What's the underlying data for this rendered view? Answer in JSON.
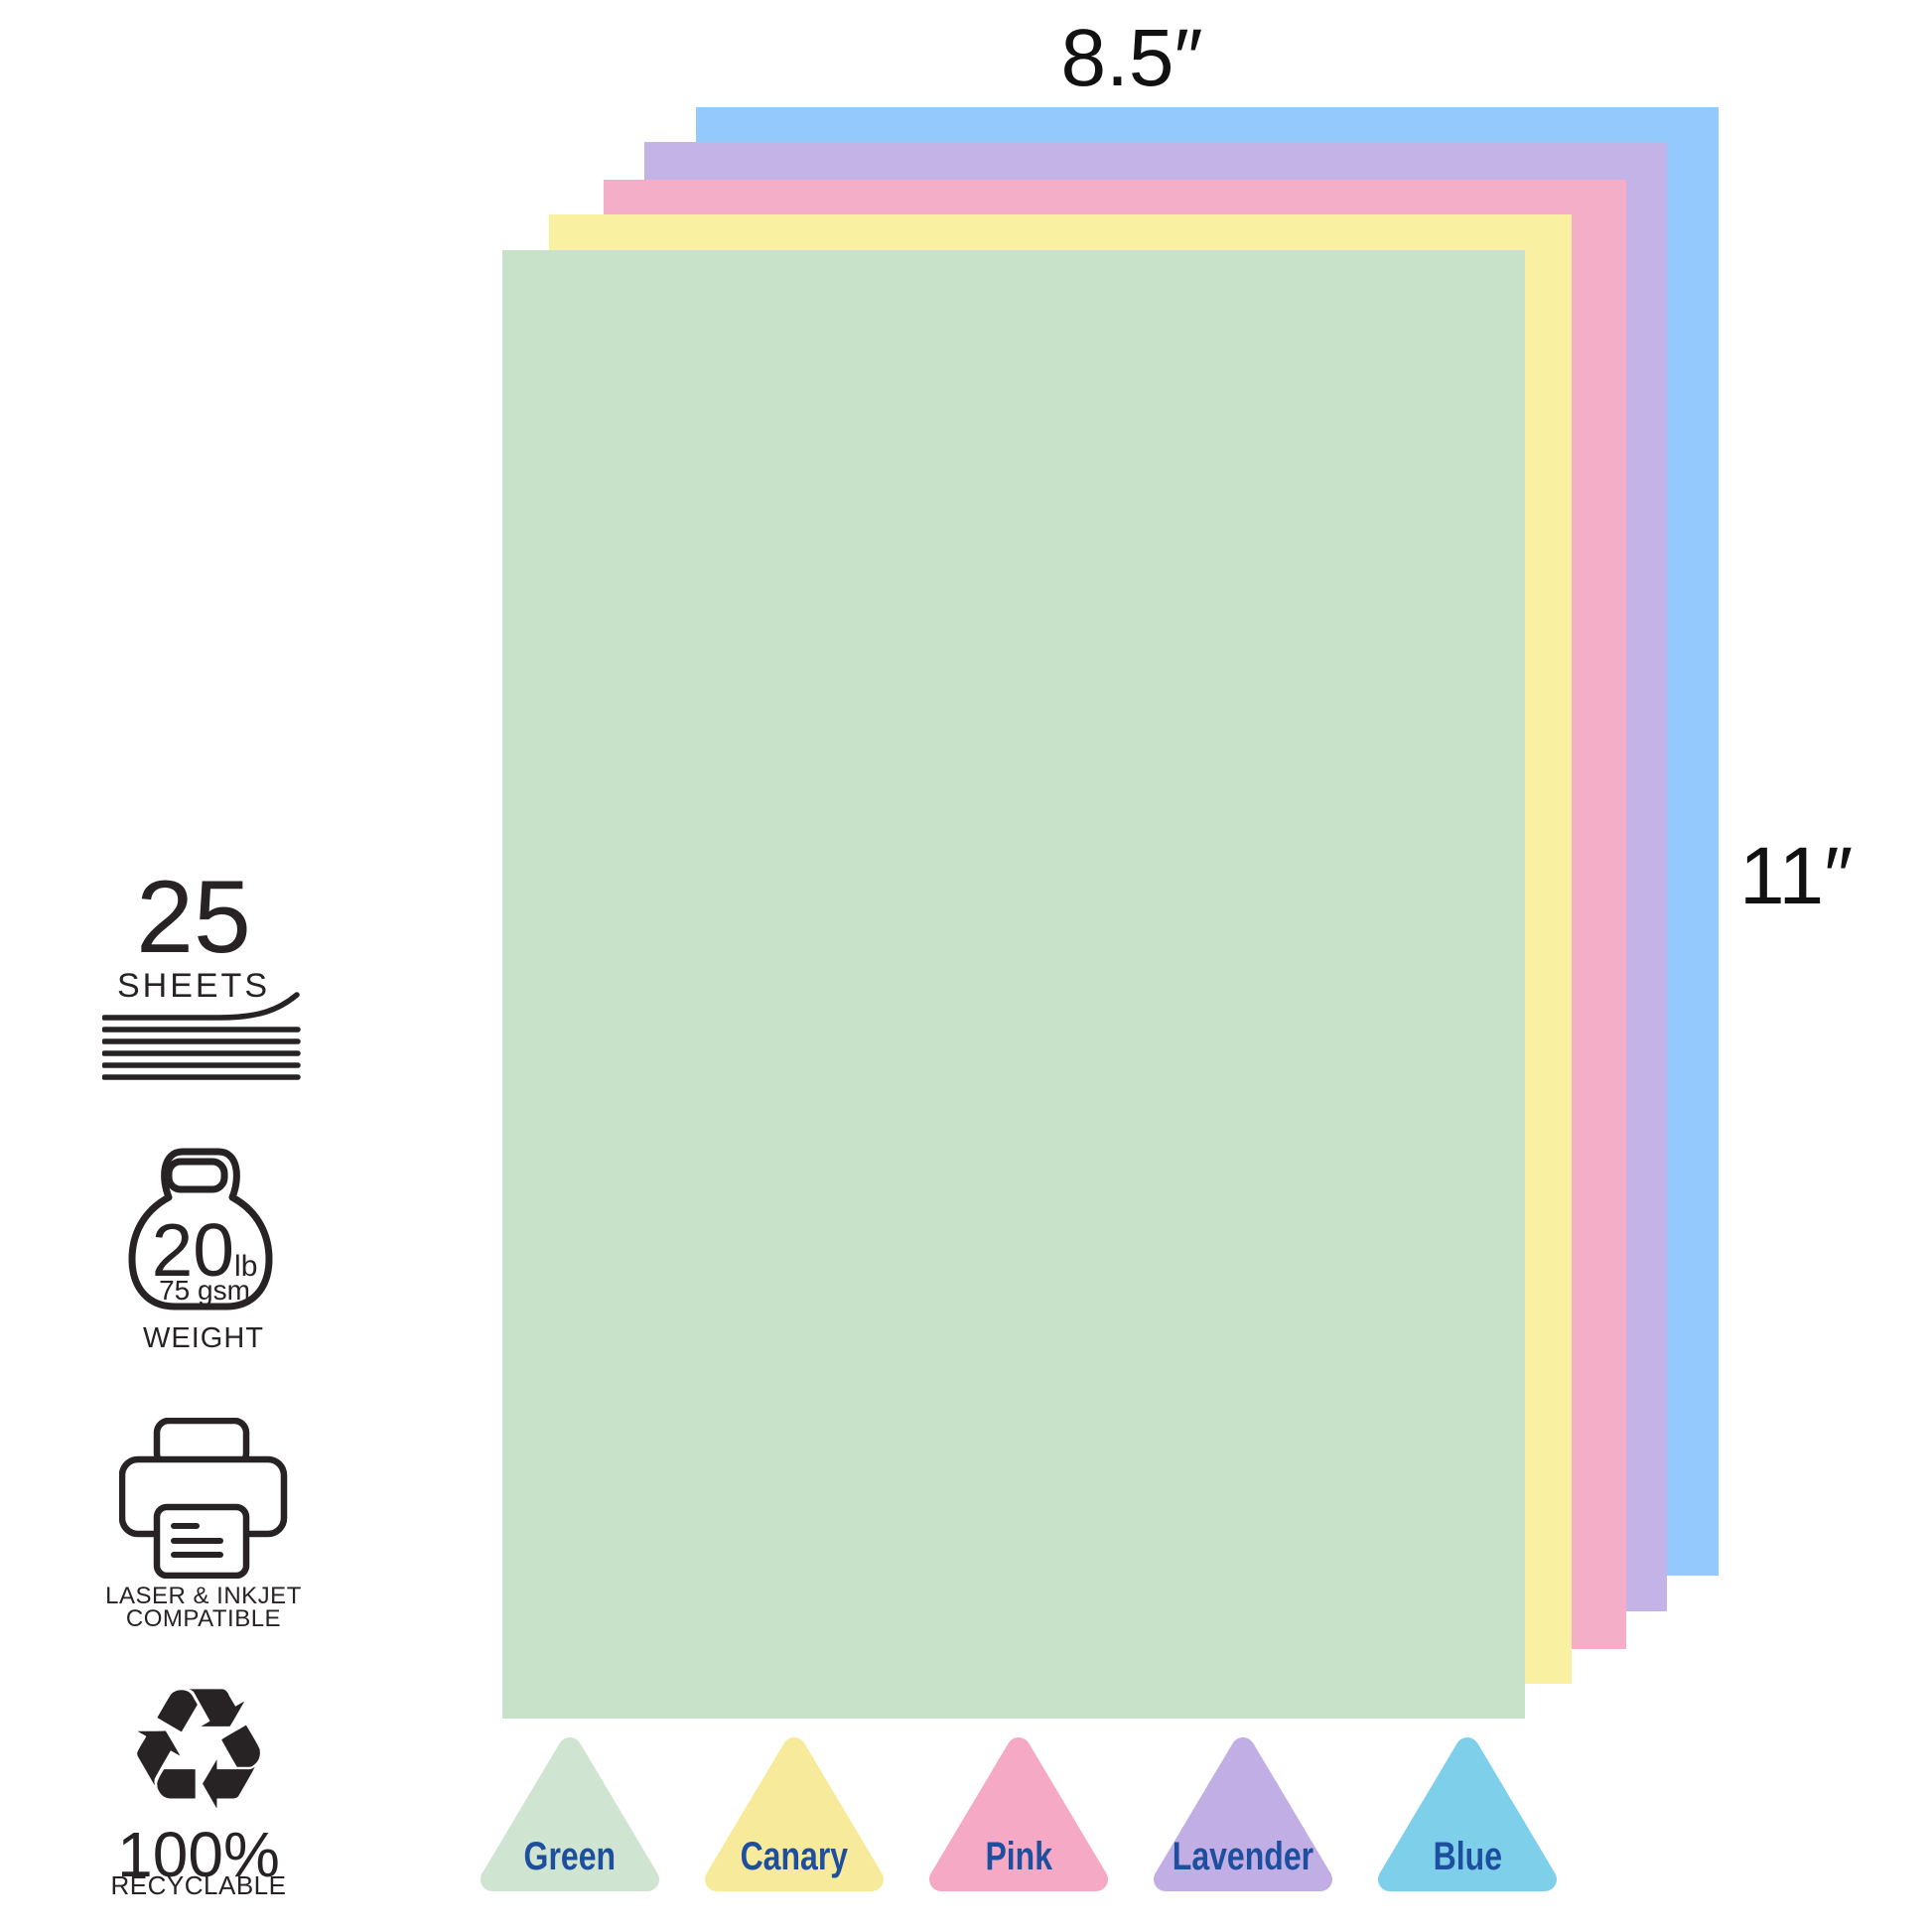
{
  "canvas": {
    "background": "#ffffff"
  },
  "colors": {
    "icon_ink": "#272324",
    "dimension_text": "#111111",
    "swatch_label_text": "#1d4f9e"
  },
  "dimensions": {
    "width_label": "8.5″",
    "height_label": "11″"
  },
  "sheets_back_to_front": [
    {
      "name": "Blue",
      "color": "#93c9fc"
    },
    {
      "name": "Lavender",
      "color": "#c4b3e6"
    },
    {
      "name": "Pink",
      "color": "#f4aec8"
    },
    {
      "name": "Canary",
      "color": "#faf0a1"
    },
    {
      "name": "Green",
      "color": "#c8e2ca"
    }
  ],
  "features": {
    "sheet_count": {
      "value": "25",
      "unit": "SHEETS"
    },
    "weight": {
      "value": "20",
      "unit": "lb",
      "metric": "75 gsm",
      "label": "WEIGHT"
    },
    "compatibility": {
      "line1": "LASER & INKJET",
      "line2": "COMPATIBLE"
    },
    "recyclable": {
      "symbol": "♻",
      "value": "100%",
      "label": "RECYCLABLE"
    }
  },
  "swatches": [
    {
      "label": "Green",
      "color": "#cfe4d1"
    },
    {
      "label": "Canary",
      "color": "#f7eb9b"
    },
    {
      "label": "Pink",
      "color": "#f5a9c4"
    },
    {
      "label": "Lavender",
      "color": "#c0aee4"
    },
    {
      "label": "Blue",
      "color": "#7ecfe9"
    }
  ]
}
